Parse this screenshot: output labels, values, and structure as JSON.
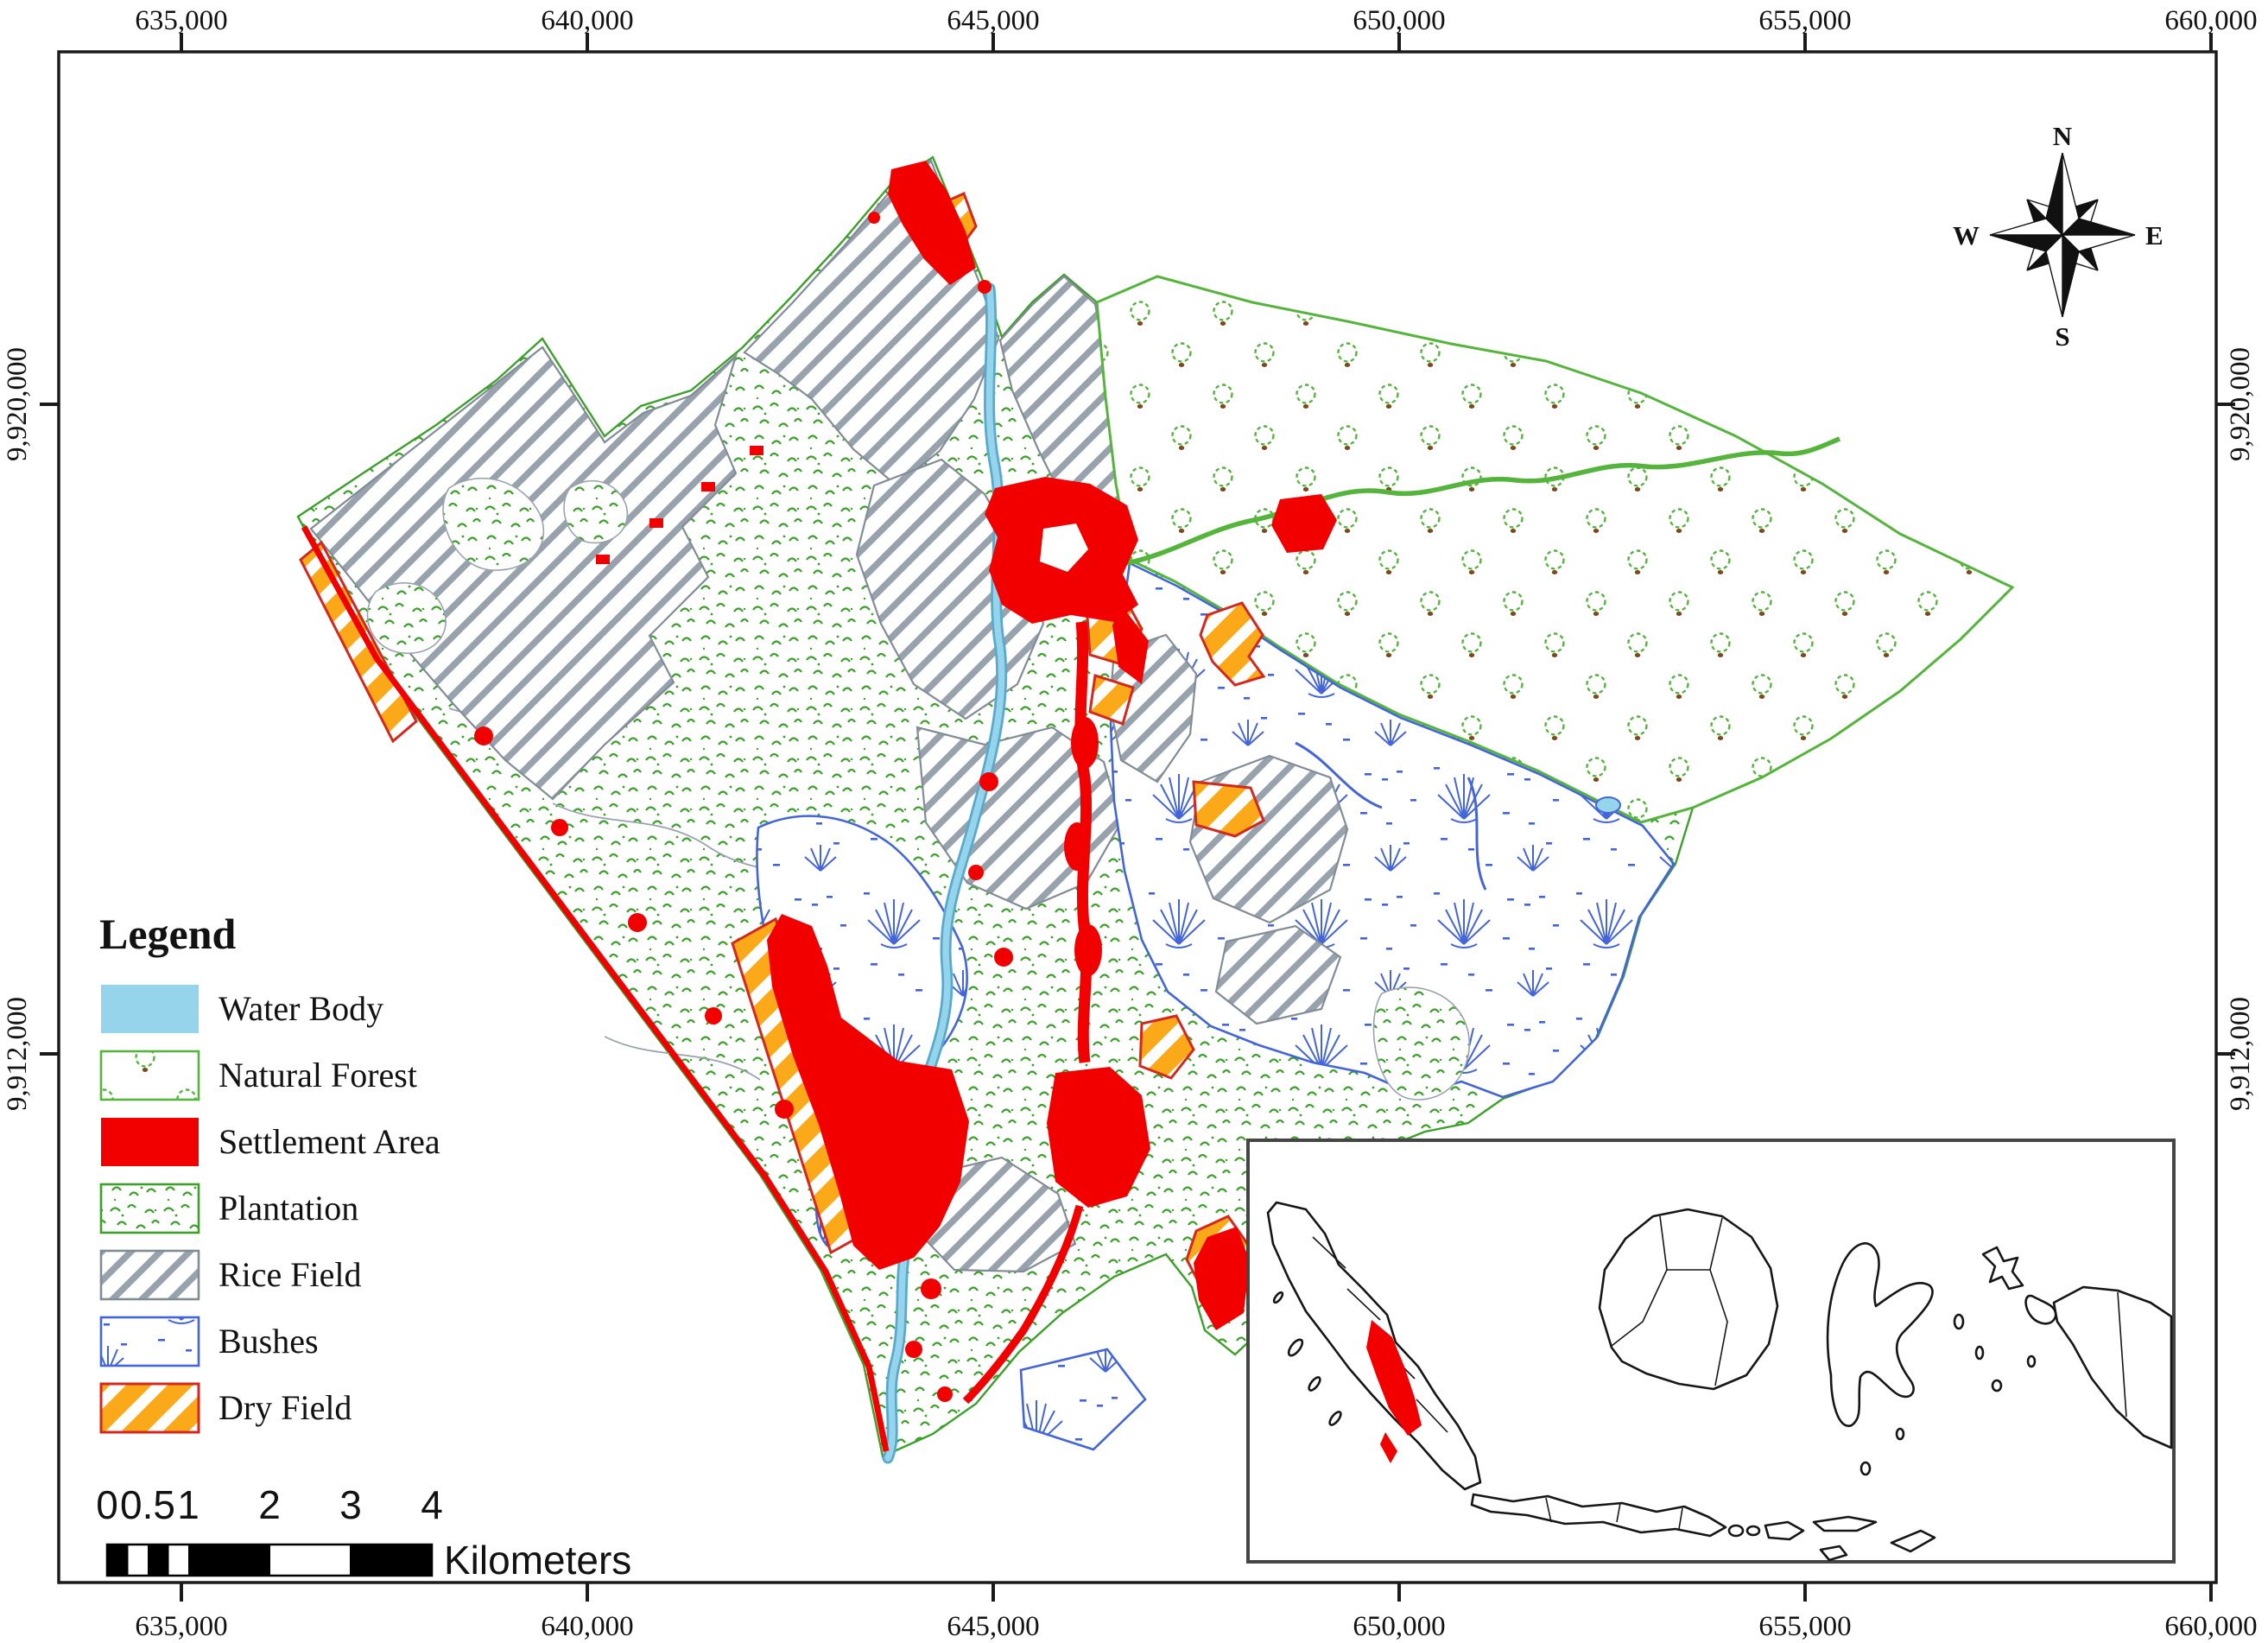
{
  "axes": {
    "x_labels": [
      "635,000",
      "640,000",
      "645,000",
      "650,000",
      "655,000",
      "660,000"
    ],
    "y_labels": [
      "9,920,000",
      "9,912,000"
    ]
  },
  "legend": {
    "title": "Legend",
    "items": [
      "Water Body",
      "Natural Forest",
      "Settlement Area",
      "Plantation",
      "Rice Field",
      "Bushes",
      "Dry Field"
    ]
  },
  "scalebar": {
    "labels": [
      "0",
      "0.5",
      "1",
      "2",
      "3",
      "4"
    ],
    "unit": "Kilometers"
  },
  "compass": {
    "n": "N",
    "e": "E",
    "s": "S",
    "w": "W"
  },
  "colors": {
    "water": "#96D4EC",
    "water_edge": "#57A9CE",
    "settlement": "#F20000",
    "dry_fill": "#FBA919",
    "dry_border": "#D3281E",
    "forest_green": "#55B43C",
    "forest_dot_brown": "#7A4A1F",
    "plantation_green": "#3CA02B",
    "rice_gray": "#98A2AC",
    "rice_border": "#828C96",
    "bushes_blue": "#4365D9"
  }
}
